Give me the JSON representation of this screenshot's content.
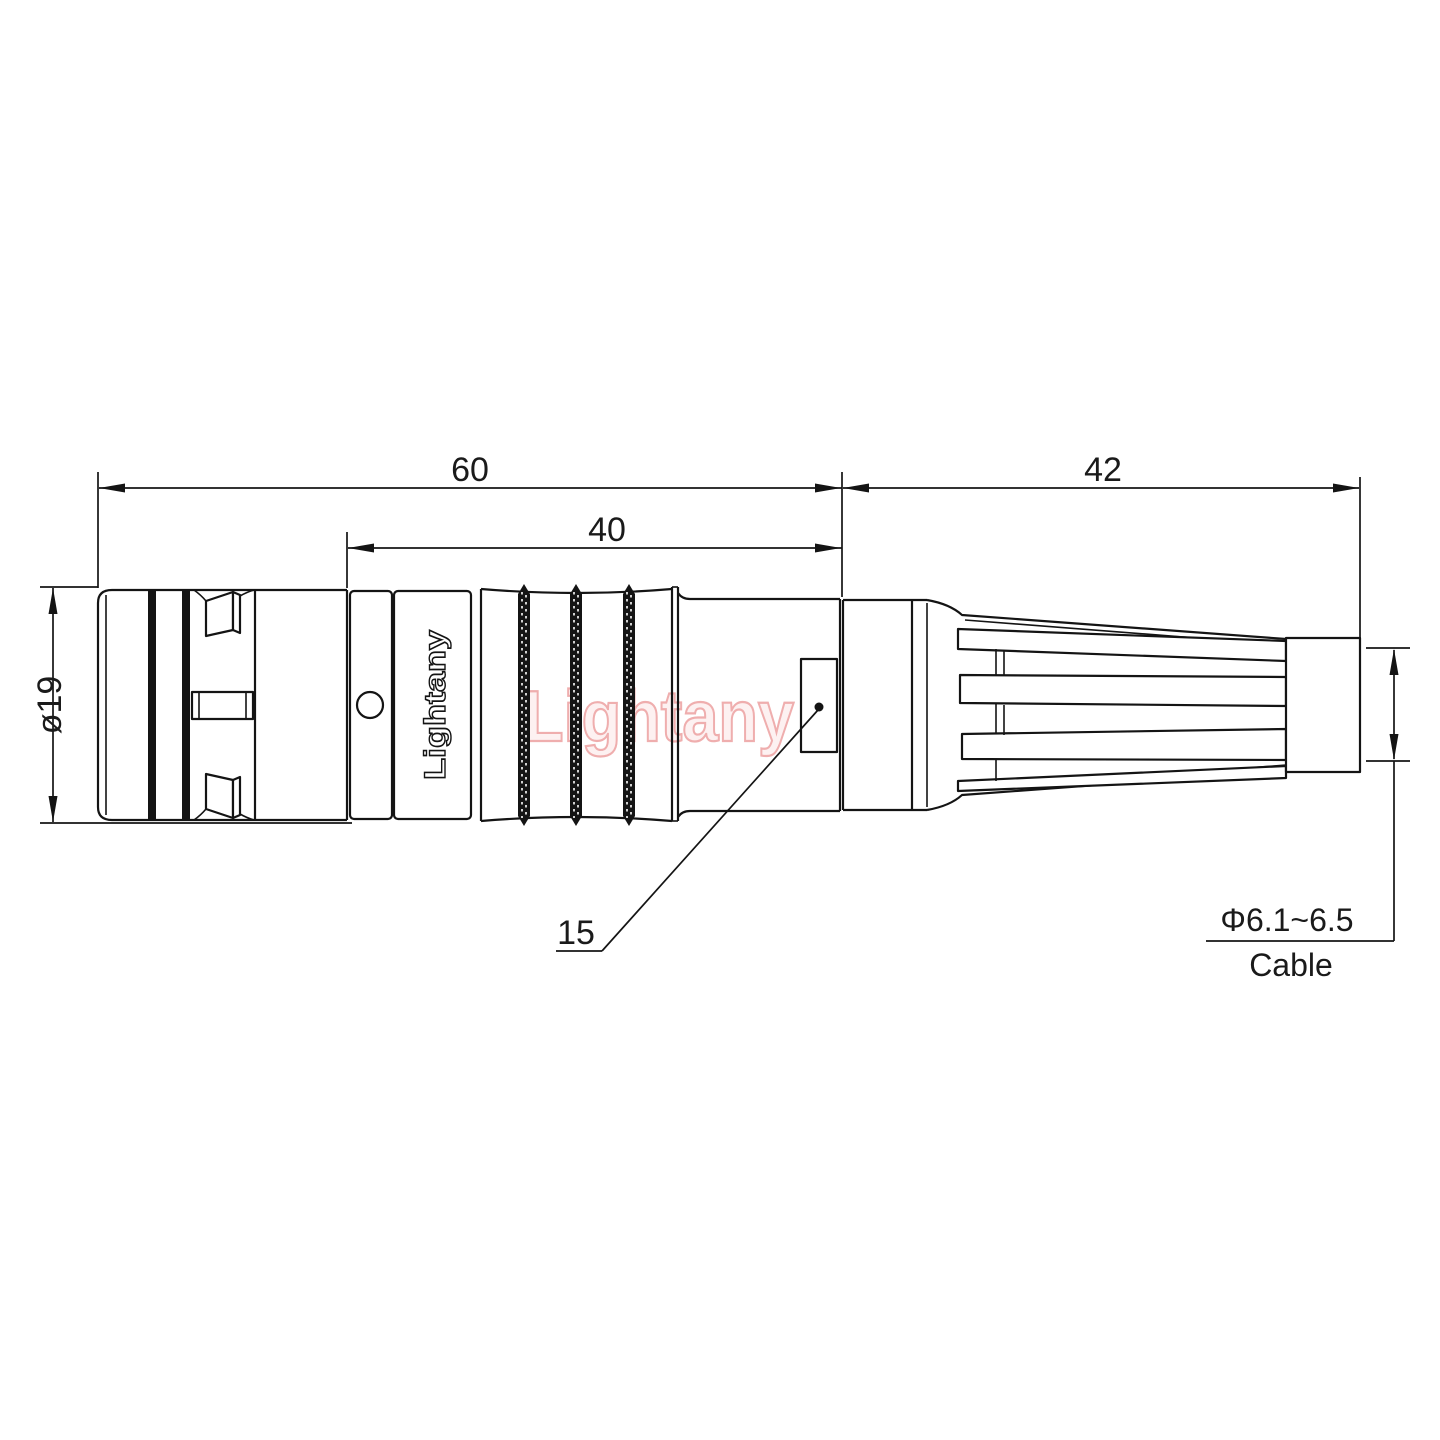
{
  "drawing": {
    "brand_engraving": "Lightany",
    "watermark": "Lightany",
    "dims": {
      "overall_length": "60",
      "rear_length": "40",
      "boot_length": "42",
      "front_diameter": "ø19",
      "leader_ref": "15",
      "cable_diameter": "Φ6.1~6.5",
      "cable_caption": "Cable"
    },
    "colors": {
      "line": "#141414",
      "text": "#1a1a1a",
      "watermark_stroke": "#efaeae",
      "watermark_fill": "#fdf1f1",
      "background": "#ffffff"
    }
  }
}
